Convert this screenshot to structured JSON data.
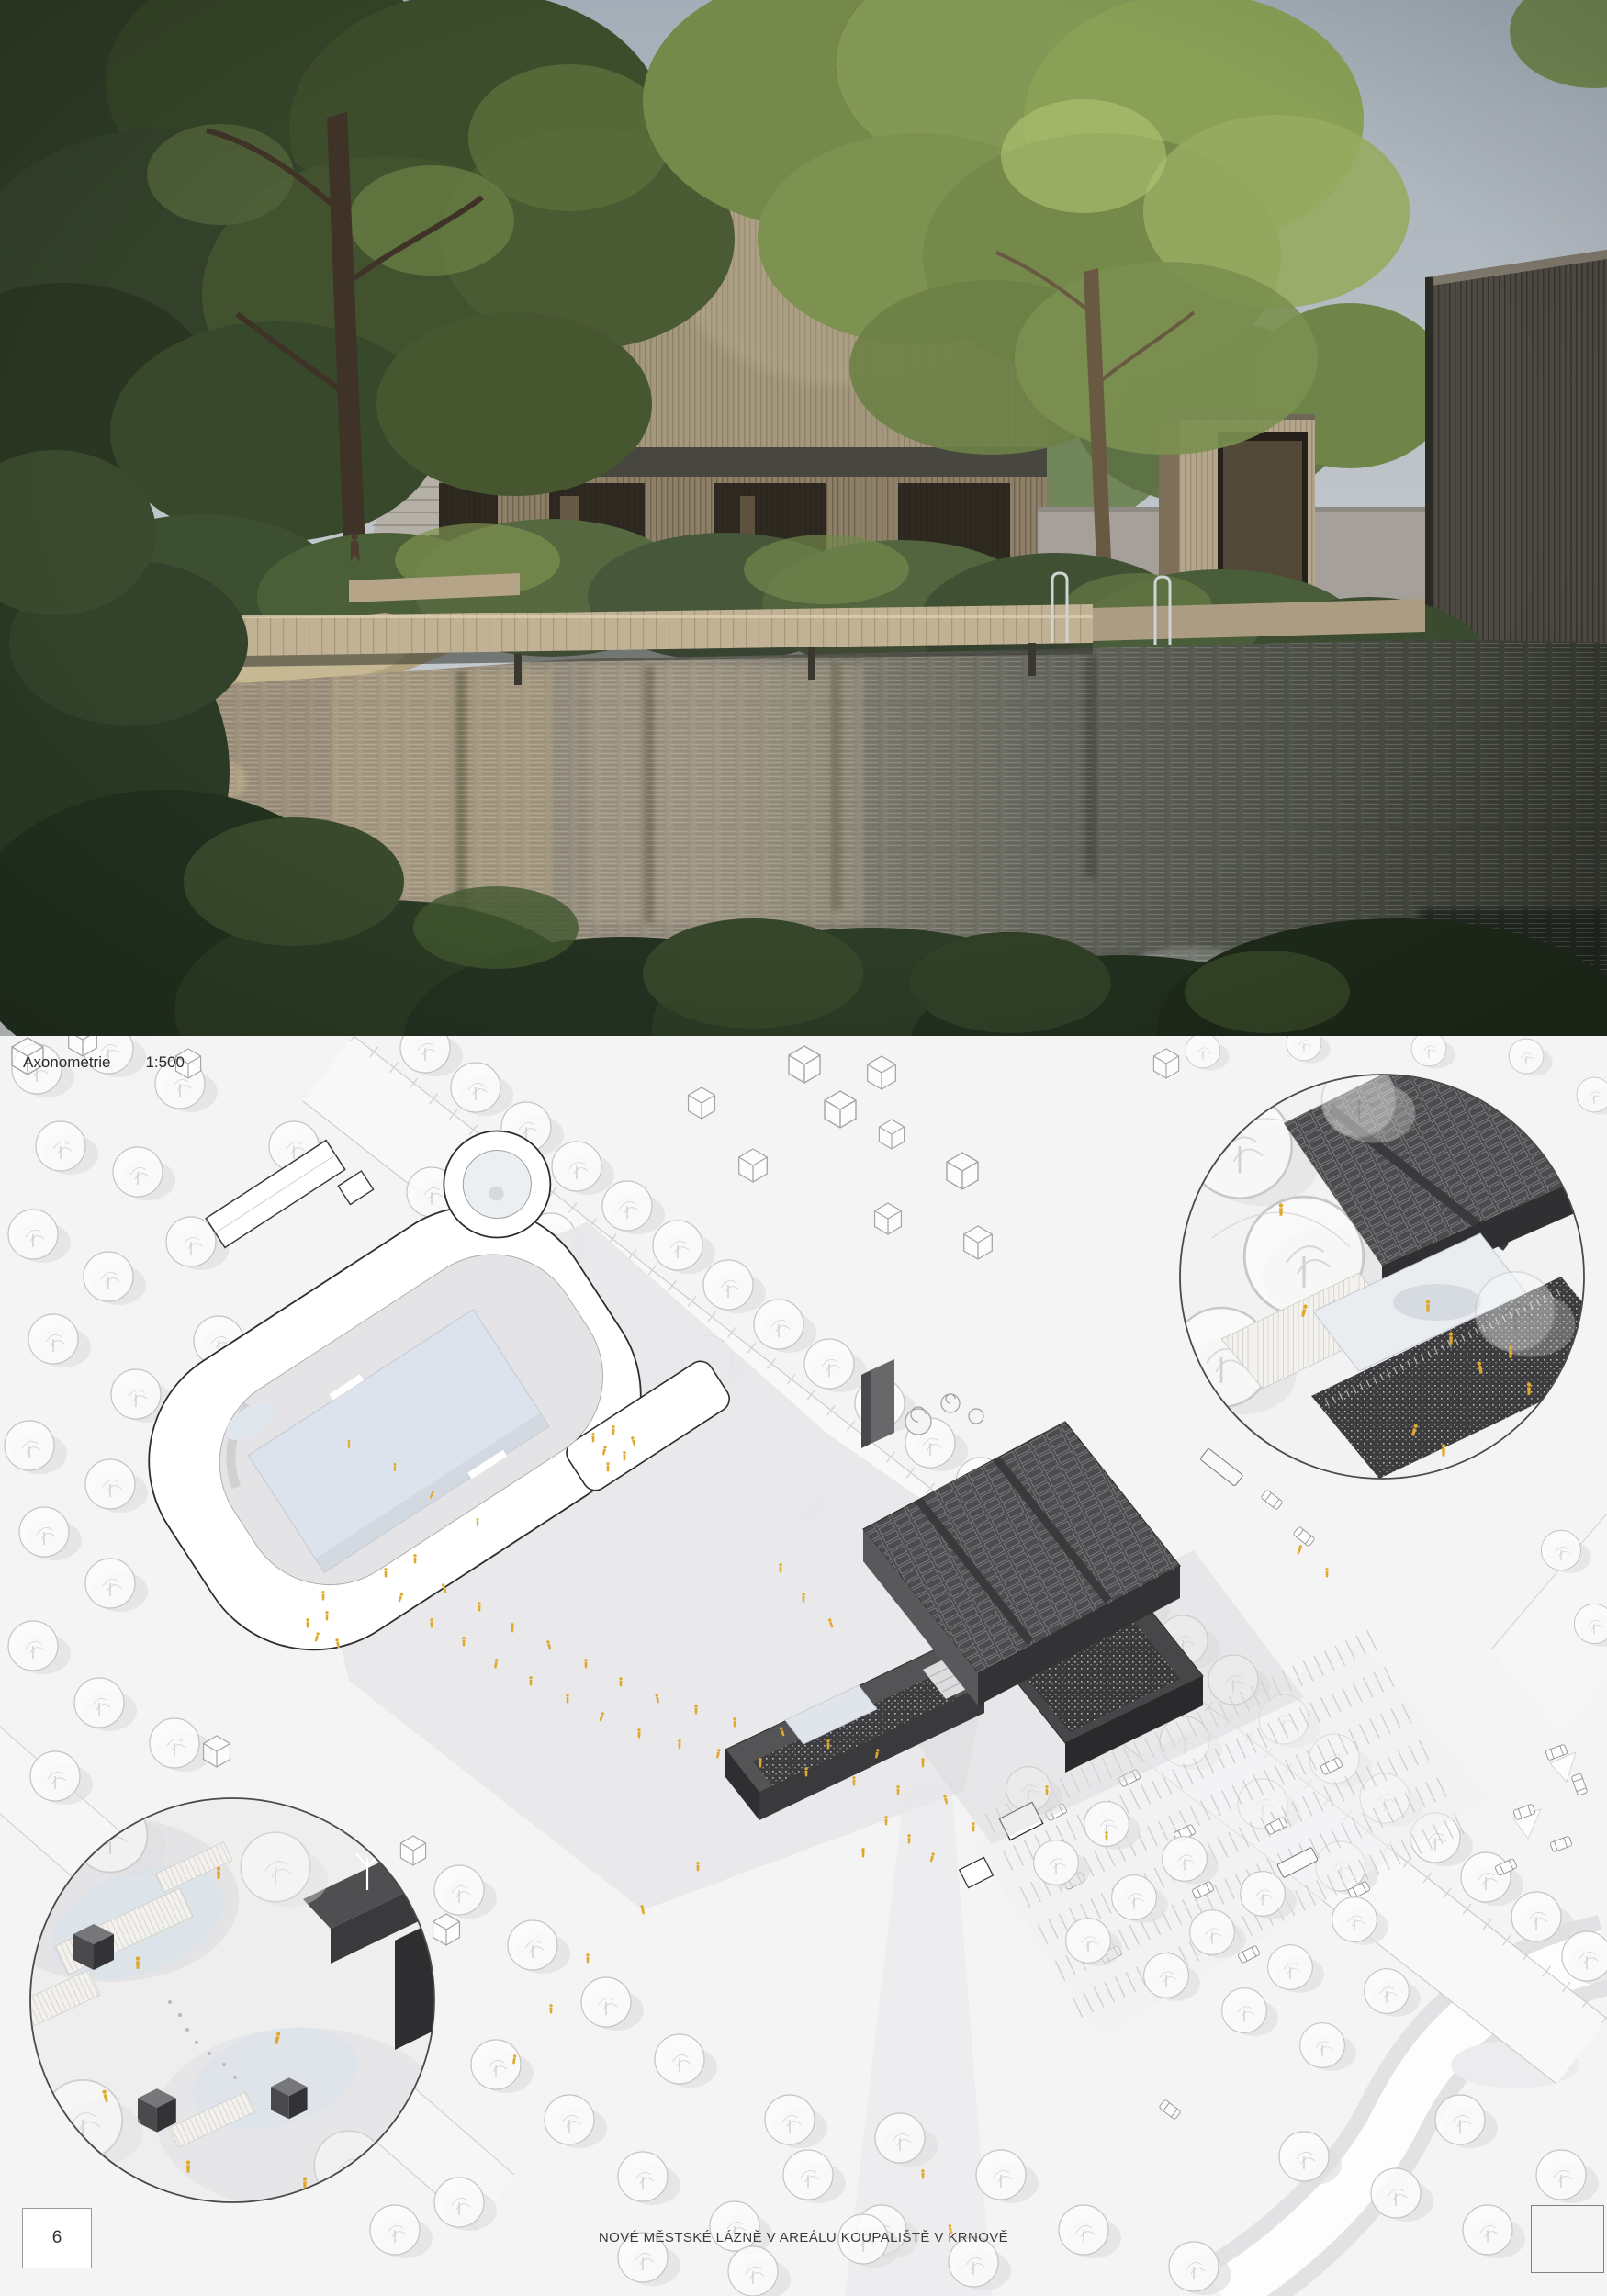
{
  "sheet": {
    "title": "NOVÉ MĚSTSKÉ LÁZNĚ V AREÁLU KOUPALIŠTĚ V KRNOVĚ",
    "page_number": "6"
  },
  "drawing": {
    "label": "Axonometrie",
    "scale": "1:500"
  },
  "colors": {
    "paper": "#f4f4f5",
    "accent_people": "#dfa92c",
    "ink": "#2f2f31",
    "plan_line": "#c6c6c8",
    "building_dark": "#4a4a4c",
    "water_plan": "#dce3ec",
    "sky": "#aab3bc",
    "timber_facade": "#b4a68c",
    "dark_timber": "#4d4943"
  }
}
